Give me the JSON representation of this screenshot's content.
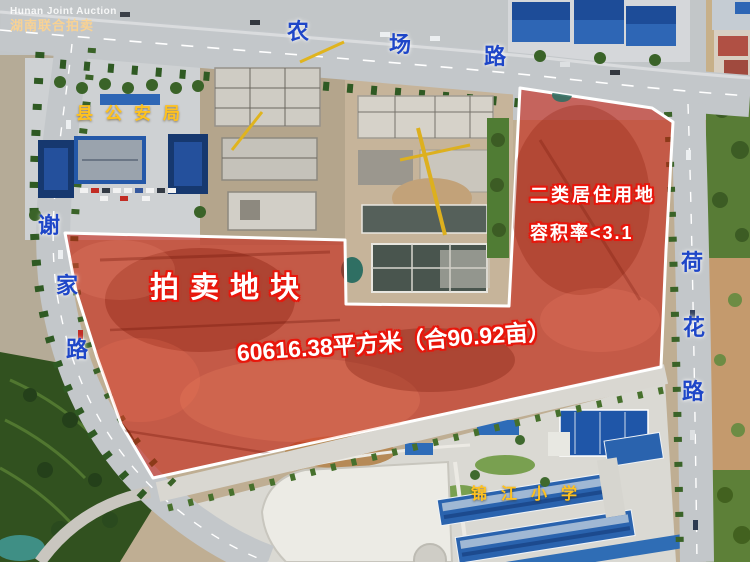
{
  "watermark": {
    "line1": "Hunan Joint Auction",
    "line2": "湖南联合拍卖"
  },
  "parcel": {
    "title": "拍卖地块",
    "area": "60616.38平方米（合90.92亩）",
    "land_use": "二类居住用地",
    "plot_ratio": "容积率<3.1",
    "fill_color": "#c81e10",
    "border_color": "#ffffff"
  },
  "pois": {
    "police": "县公安局",
    "school": "锦江小学"
  },
  "roads": {
    "top": {
      "name": "农场路",
      "chars": [
        "农",
        "场",
        "路"
      ]
    },
    "left": {
      "name": "谢家路",
      "chars": [
        "谢",
        "家",
        "路"
      ]
    },
    "right": {
      "name": "荷花路",
      "chars": [
        "荷",
        "花",
        "路"
      ]
    }
  },
  "colors": {
    "road_label": "#1e46c8",
    "poi_label": "#ffc21e",
    "annotation_fill": "#ffffff",
    "annotation_outline": "#e8170c"
  }
}
